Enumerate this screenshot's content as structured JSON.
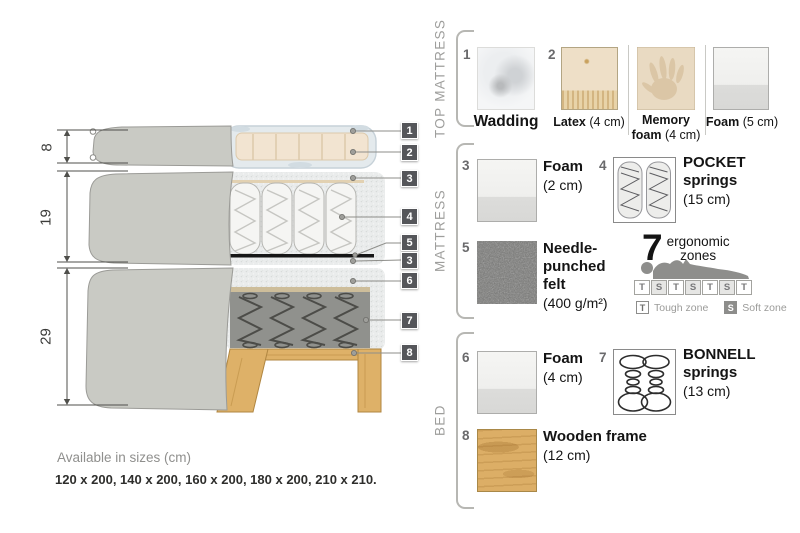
{
  "colors": {
    "fabric": "#c9cac4",
    "fabric_border": "#9b9b97",
    "latex_beige": "#f2e4d1",
    "wadding_white": "#e4eaed",
    "foam_speckle": "#eaecec",
    "felt_black": "#161616",
    "bonnell_gray": "#90918d",
    "wood": "#deb168",
    "label_square": "#55565a",
    "text_dark": "#141414",
    "text_muted": "#9e9e9c"
  },
  "diagram": {
    "dims": [
      {
        "value": "8"
      },
      {
        "value": "19"
      },
      {
        "value": "29"
      }
    ],
    "labels": [
      {
        "n": "1"
      },
      {
        "n": "2"
      },
      {
        "n": "3"
      },
      {
        "n": "4"
      },
      {
        "n": "5"
      },
      {
        "n": "3"
      },
      {
        "n": "6"
      },
      {
        "n": "7"
      },
      {
        "n": "8"
      }
    ]
  },
  "panel": {
    "top_mattress": {
      "title": "TOP MATTRESS",
      "wadding": {
        "num": "1",
        "name": "Wadding"
      },
      "latex": {
        "num": "2",
        "name": "Latex",
        "size": "(4 cm)"
      },
      "memory": {
        "name1": "Memory",
        "name2": "foam",
        "size": "(4 cm)"
      },
      "foam": {
        "name": "Foam",
        "size": "(5 cm)"
      }
    },
    "mattress": {
      "title": "MATTRESS",
      "foam": {
        "num": "3",
        "name": "Foam",
        "size": "(2 cm)"
      },
      "pocket": {
        "num": "4",
        "name1": "POCKET",
        "name2": "springs",
        "size": "(15 cm)"
      },
      "felt": {
        "num": "5",
        "name1": "Needle-",
        "name2": "punched",
        "name3": "felt",
        "size": "(400 g/m²)"
      },
      "ergonomic": {
        "number": "7",
        "word1": "ergonomic",
        "word2": "zones",
        "zones": [
          "T",
          "S",
          "T",
          "S",
          "T",
          "S",
          "T"
        ],
        "legend_t_key": "T",
        "legend_t": "Tough zone",
        "legend_s_key": "S",
        "legend_s": "Soft zone"
      }
    },
    "bed": {
      "title": "BED",
      "foam": {
        "num": "6",
        "name": "Foam",
        "size": "(4 cm)"
      },
      "bonnell": {
        "num": "7",
        "name1": "BONNELL",
        "name2": "springs",
        "size": "(13 cm)"
      },
      "frame": {
        "num": "8",
        "name": "Wooden frame",
        "size": "(12 cm)"
      }
    }
  },
  "footer": {
    "title": "Available in sizes (cm)",
    "sizes": "120 x 200, 140 x 200, 160 x 200, 180 x 200, 210 x 210."
  }
}
